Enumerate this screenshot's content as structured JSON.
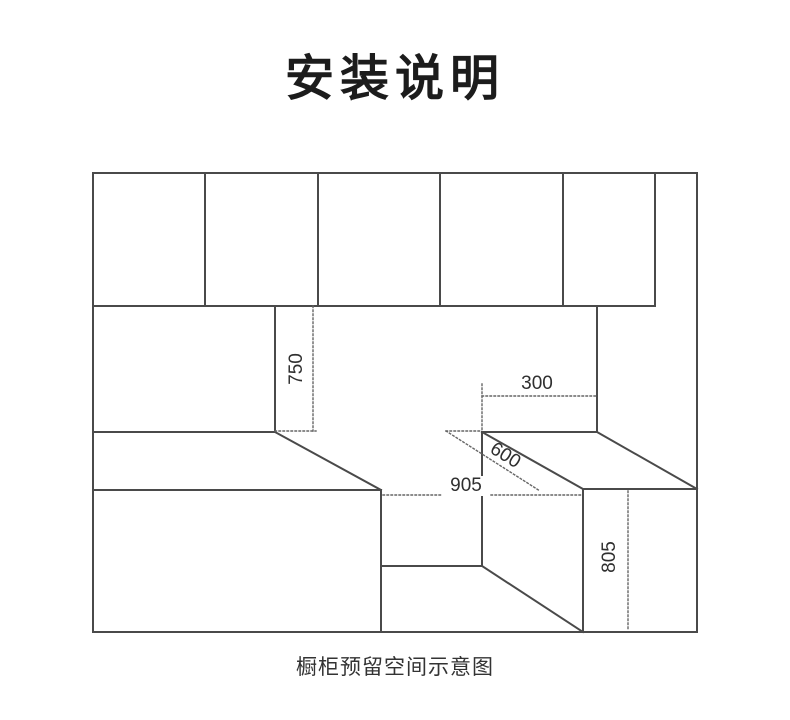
{
  "title": "安装说明",
  "caption": "橱柜预留空间示意图",
  "diagram": {
    "description": "cabinet reserved space schematic",
    "dims": {
      "clearance_height": "750",
      "upper_right_width": "300",
      "counter_depth": "600",
      "opening_width": "905",
      "base_height": "805"
    }
  }
}
